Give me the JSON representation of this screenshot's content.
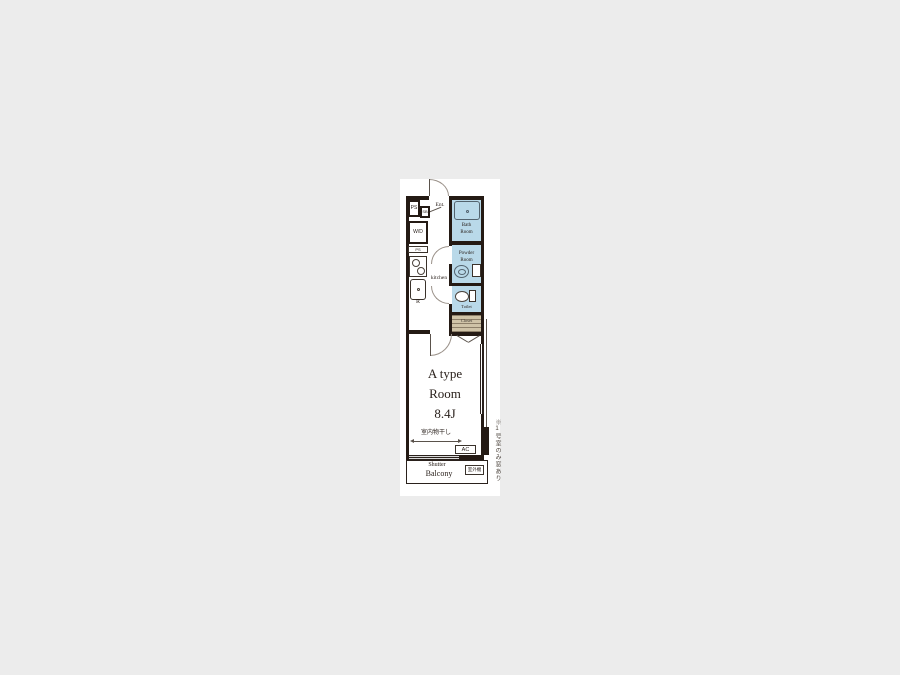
{
  "colors": {
    "wall": "#241a14",
    "wet_fill": "#b9d9e9",
    "closet_fill": "#cfc3a7",
    "page_bg": "#ececec",
    "sheet_bg": "#ffffff"
  },
  "plan": {
    "entry": {
      "ps": "PS",
      "shoe_box": "SB",
      "entrance": "Ent.",
      "washer_dryer": "W/D",
      "ps_lower": "PS"
    },
    "kitchen": {
      "label": "kitchen",
      "refrigerator": "R"
    },
    "bath": {
      "line1": "Bath",
      "line2": "Room"
    },
    "powder": {
      "line1": "Powder",
      "line2": "Room"
    },
    "toilet": {
      "label": "Toilet"
    },
    "closet": {
      "label": "Closet"
    },
    "room": {
      "line1": "A type",
      "line2": "Room",
      "line3": "8.4J"
    },
    "equipment": {
      "indoor_drying": "室内物干し",
      "ac": "AC"
    },
    "balcony": {
      "shutter": "Shutter",
      "label": "Balcony",
      "outdoor_unit": "室外機"
    },
    "note": {
      "side_vertical": "※1号室のみ窓あり"
    }
  }
}
